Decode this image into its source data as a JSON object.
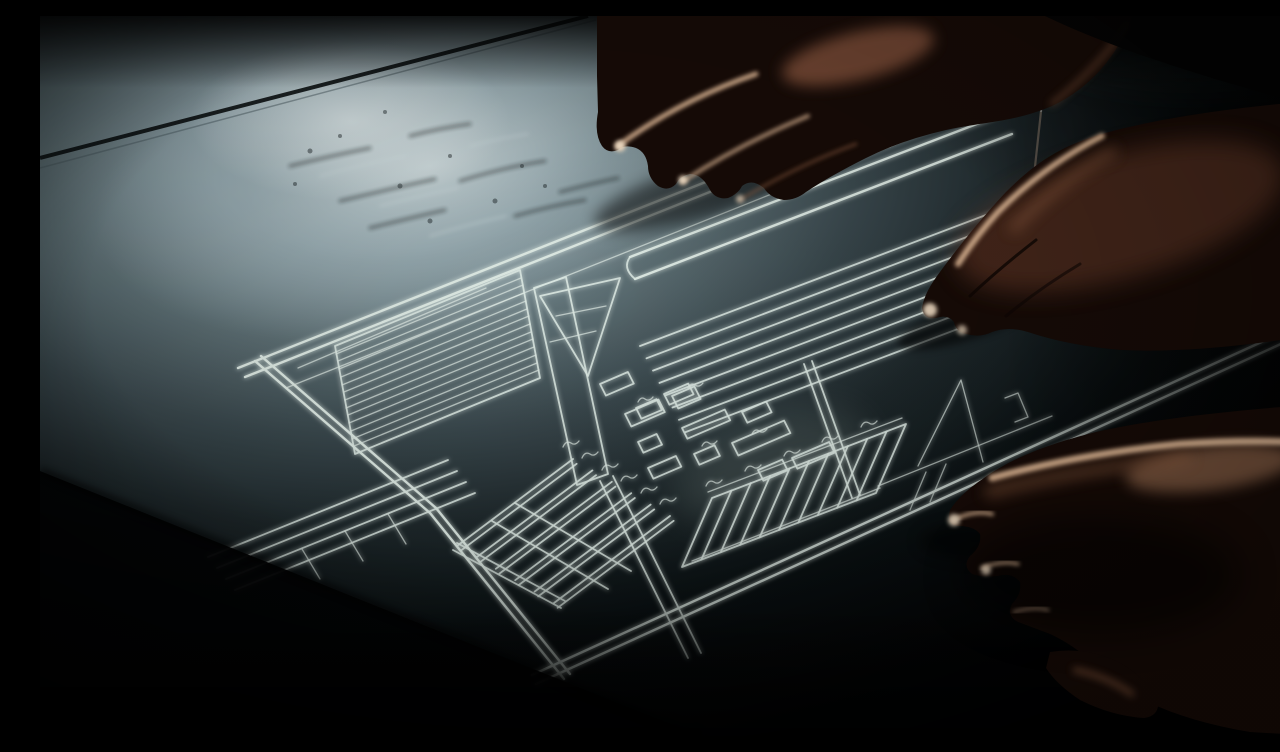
{
  "meta": {
    "type": "photograph",
    "description": "Dramatically lit photograph of hands over a technical blueprint drawn in white chalk-like lines on a dark drafting table; light falls from the upper left where chalk dust smudges the surface.",
    "width_px": 1280,
    "height_px": 720
  },
  "colors": {
    "bg-edge": "#040608",
    "bg-core": "#a7b8bd",
    "table-lit": "#ccd8da",
    "table-mid": "#46555a",
    "bp-line": "#dce8e2",
    "seam": "#0a0e0f",
    "dust-dark": "#141b1d",
    "dust-light": "#d7e2e4",
    "skin-deep": "#150a06",
    "skin-mid": "#8a5a3e",
    "skin-lit": "#d8b291",
    "skin-bright": "#e9d6bd",
    "pencil": "#565048",
    "corner-glint": "#e8f2f2",
    "shadow": "#000000"
  },
  "scene": {
    "setting": "dark drafting table with a chalk blueprint drawing",
    "objects": [
      "table-surface",
      "light-pool",
      "chalk-dust",
      "table-seam-line",
      "table-edge-shadow",
      "blueprint-drawing",
      "pencil-line",
      "corner-glint",
      "hand-top",
      "hand-right",
      "hand-bottom"
    ],
    "blueprint_elements": [
      "frame-border",
      "hatch-panel",
      "support-column",
      "top-bar",
      "connector-triangle",
      "parts-cluster",
      "line-field",
      "left-lines",
      "left-comb",
      "right-comb",
      "annotation-marks",
      "dimension-squiggles"
    ],
    "hands": [
      {
        "id": "hand-top",
        "position": "top-center",
        "pose": "fingers spread downward touching the drawing"
      },
      {
        "id": "hand-right",
        "position": "middle-right",
        "pose": "fingers extended pointing at the drawing"
      },
      {
        "id": "hand-bottom",
        "position": "bottom-right",
        "pose": "relaxed hand with curled fingers and thumb"
      }
    ]
  }
}
